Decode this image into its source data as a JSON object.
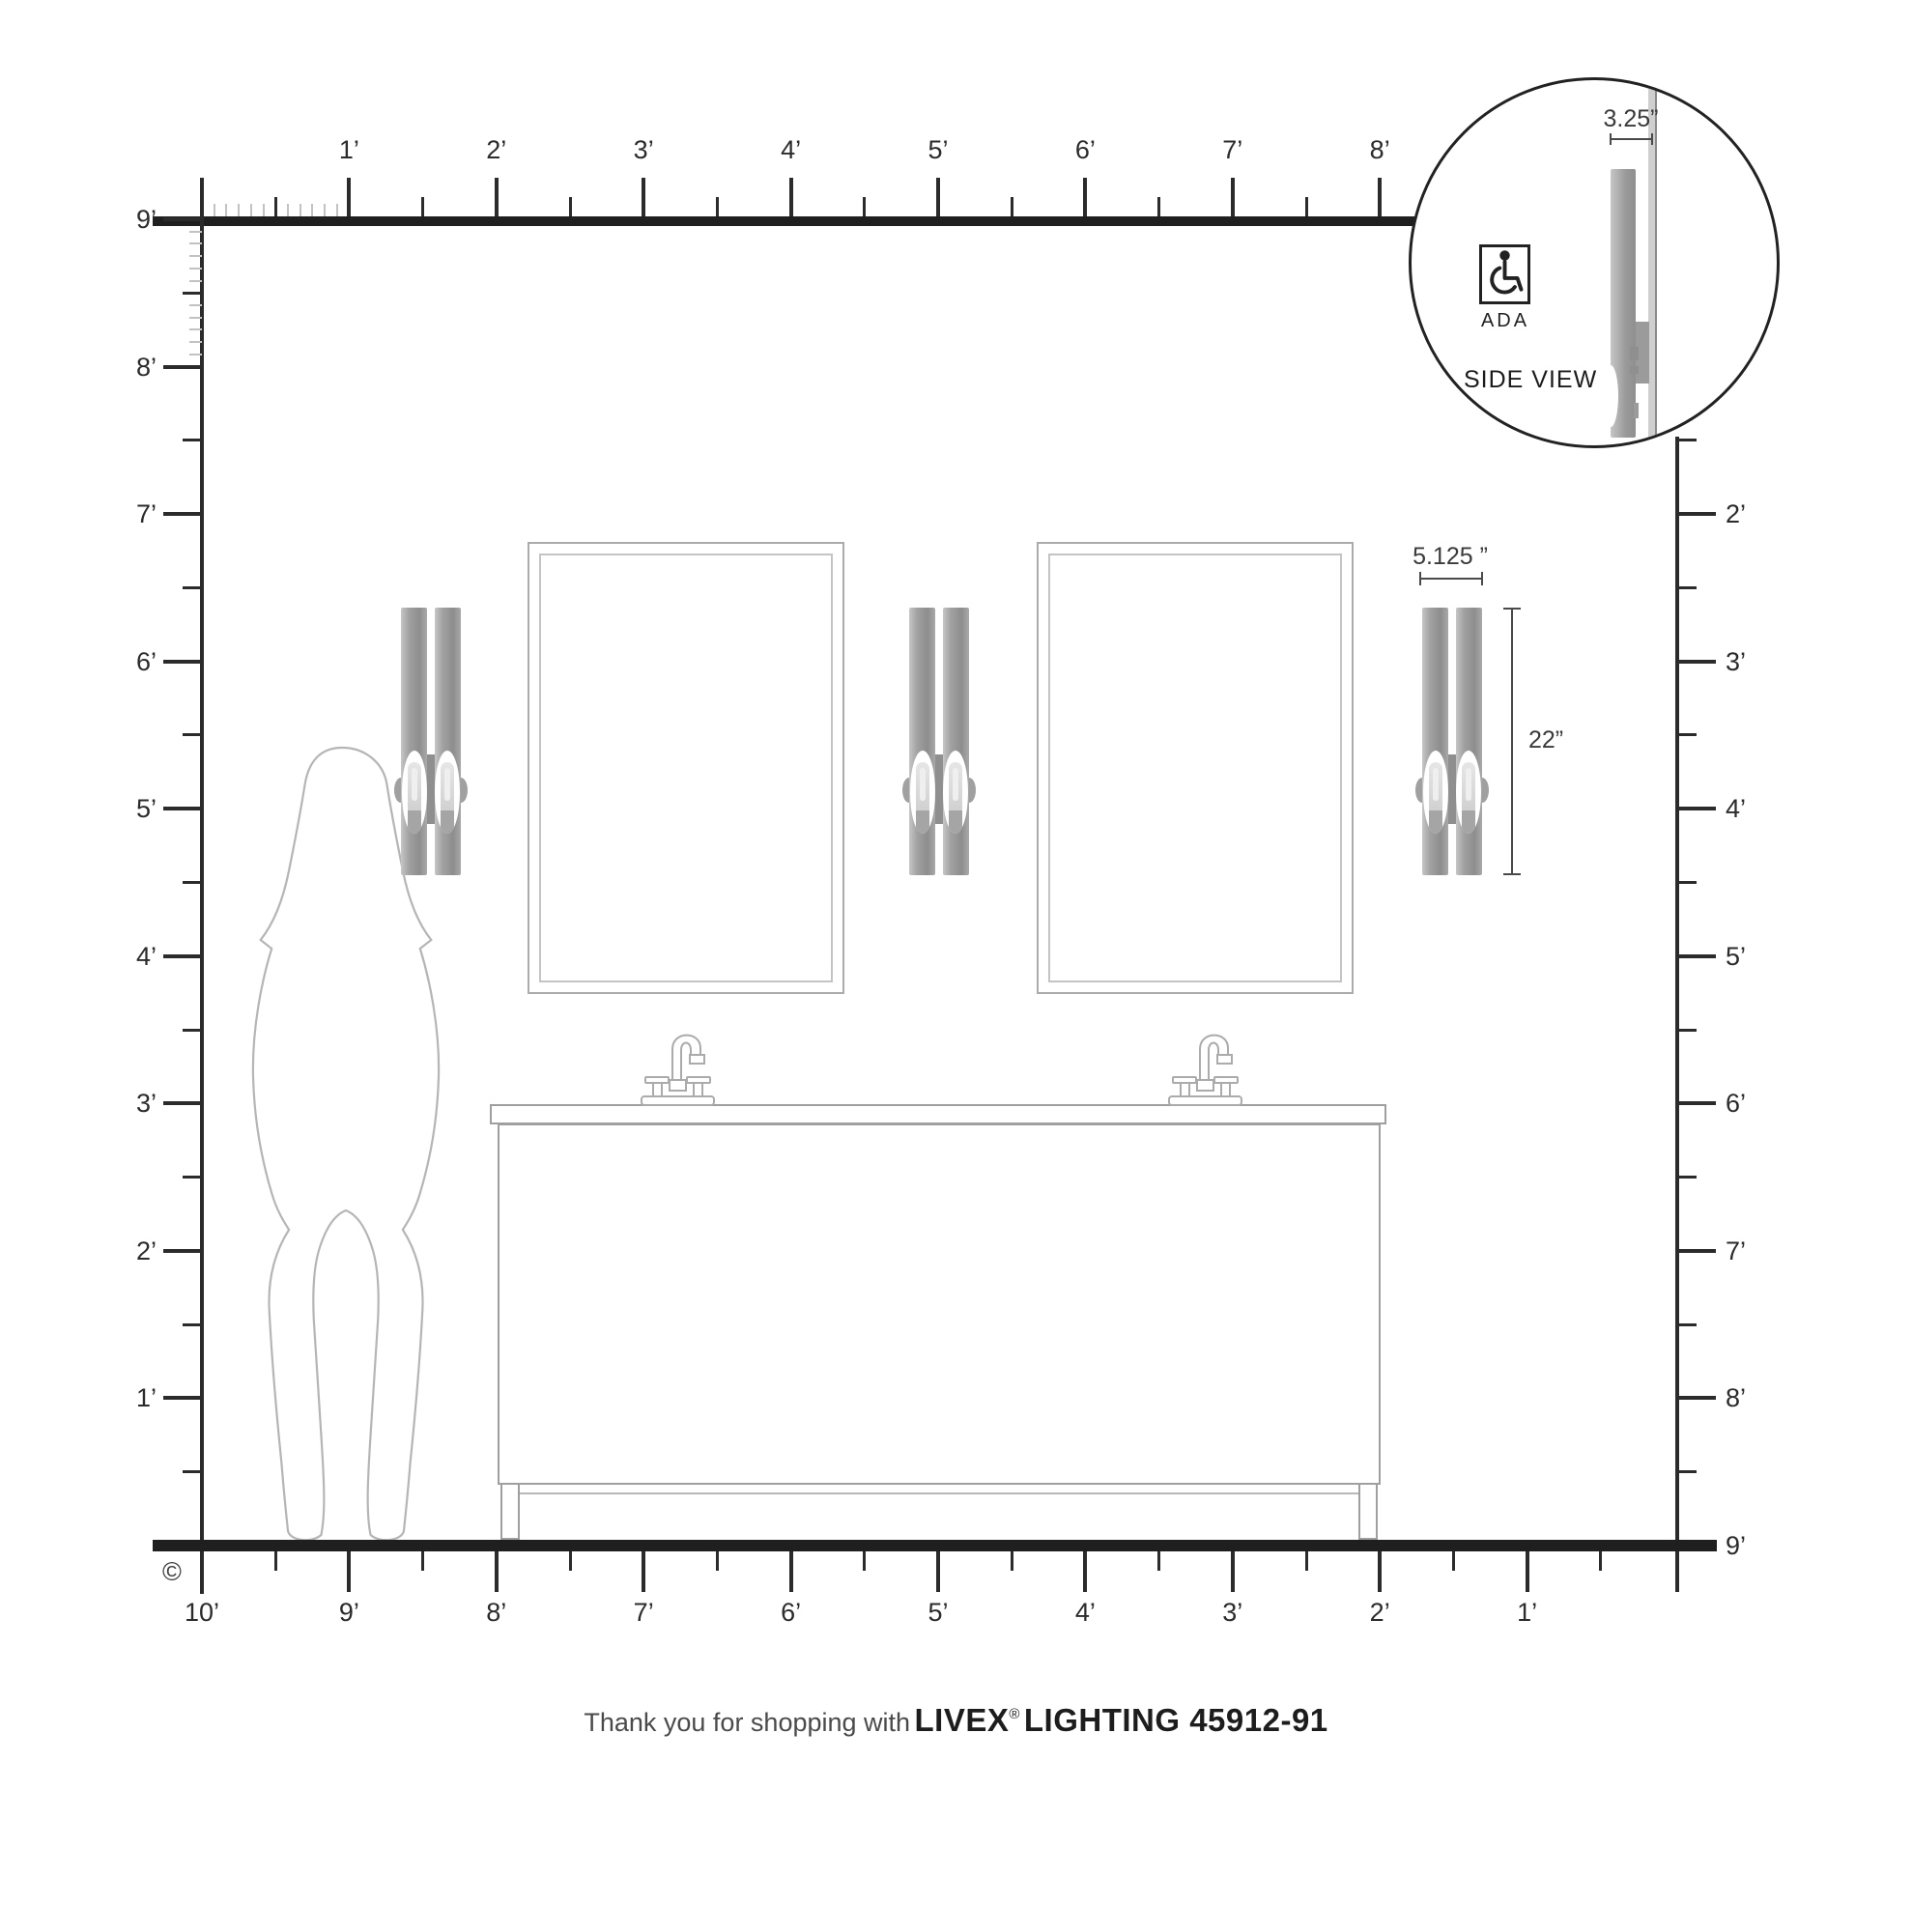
{
  "rulers": {
    "top_labels": [
      "1’",
      "2’",
      "3’",
      "4’",
      "5’",
      "6’",
      "7’",
      "8’"
    ],
    "left_labels": [
      "9’",
      "8’",
      "7’",
      "6’",
      "5’",
      "4’",
      "3’",
      "2’",
      "1’"
    ],
    "right_labels": [
      "2’",
      "3’",
      "4’",
      "5’",
      "6’",
      "7’",
      "8’",
      "9’"
    ],
    "bottom_labels": [
      "10’",
      "9’",
      "8’",
      "7’",
      "6’",
      "5’",
      "4’",
      "3’",
      "2’",
      "1’"
    ]
  },
  "fixture_dimensions": {
    "width": "5.125 ”",
    "height": "22”"
  },
  "inset": {
    "width_dimension": "3.25”",
    "ada_label": "ADA",
    "side_view_label": "SIDE VIEW"
  },
  "footer": {
    "prefix": "Thank you for shopping with",
    "brand": "LIVEX",
    "registered_mark": "®",
    "product": "LIGHTING 45912-91"
  },
  "copyright_symbol": "©",
  "colors": {
    "line_dark": "#2b2b2b",
    "thick_line": "#1f1f1f",
    "outline_gray": "#b2b2b2",
    "fixture_gray": "#9a9a9a"
  }
}
